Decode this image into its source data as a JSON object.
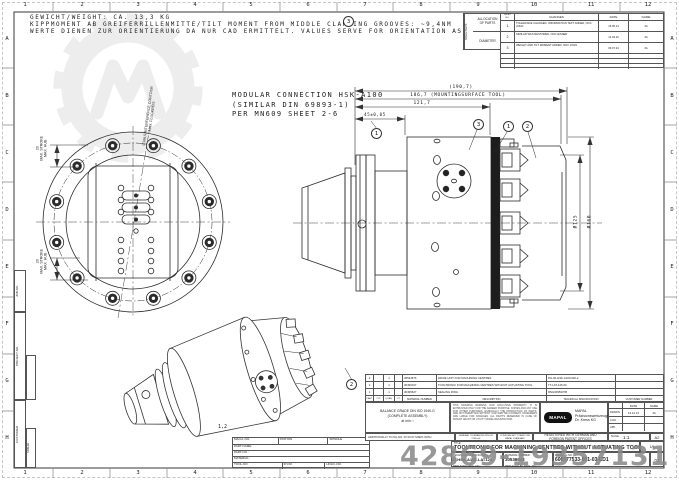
{
  "watermark": {
    "number": "42869-19357131"
  },
  "frame": {
    "columns": [
      "1",
      "2",
      "3",
      "4",
      "5",
      "6",
      "7",
      "8",
      "9",
      "10",
      "11",
      "12"
    ],
    "rows": [
      "A",
      "B",
      "C",
      "D",
      "E",
      "F",
      "G",
      "H"
    ],
    "left_fields": {
      "job_no": "JOB-NO.",
      "project_no": "PROJECT-NO.",
      "customer": "CUSTOMER",
      "similar": "SIMILAR"
    }
  },
  "notes": {
    "weight": "GEWICHT/WEIGHT: CA. 13,3 KG",
    "tilt": "KIPPMOMENT AB GREIFERRILLENMITTE/TILT MOMENT FROM MIDDLE CLAMPING GROOVES: ~9,4NM",
    "orientation": "WERTE DIENEN ZUR ORIENTIERUNG DA NUR CAD ERMITTELT. VALUES SERVE FOR ORIENTATION AS ONLY CAD DETERMINES."
  },
  "connection_note": "MODULAR CONNECTION HSK-A100\n(SIMILAR DIN 69893-1)\nPER  MN609 SHEET 2-6",
  "revision_table": {
    "allocation": {
      "title": "ALLOCATION\nOF PARTS",
      "spare": "SPARE PARTS",
      "diameter": "DIAMETER"
    },
    "headers": {
      "index": "INDEX\nNO.",
      "changes": "CHANGES",
      "date": "DATE",
      "name": "NAME"
    },
    "rows": [
      {
        "no": "1",
        "change": "TOLERANCE CHANGED, INFORMATION TEXT ADDED, NOC JOHN",
        "date": "15.05.14",
        "name": "JG"
      },
      {
        "no": "2",
        "change": "SIMILAR WAS RESTORED, NOC EISNER",
        "date": "14.03.20",
        "name": "JG"
      },
      {
        "no": "3",
        "change": "WEIGHT AND TILT MOMENT ADDED, NOC JOHN",
        "date": "09.07.24",
        "name": "JG"
      }
    ]
  },
  "dimensions": {
    "overall": "(190,7)",
    "mounting": "186,7 (MOUNTINGSURFACE TOOL)",
    "body": "121,7",
    "face": "45±0,05",
    "dia125": "Ø125",
    "dia160": "Ø160",
    "stroke_label": "20\nMAX. STROKE\nMAX. HUB",
    "interference": "Ø166,5 INTERFERENCE CONTOUR\nMAX. FLUGKREIS",
    "iso_ref": "1,2"
  },
  "balloons": {
    "b1": "1",
    "b2": "2",
    "b3": "3"
  },
  "parts_list": {
    "headers": {
      "part": "PART",
      "typ": "TYP",
      "quan": "QUAN.",
      "ut": "UT",
      "material_number": "MATERIAL NUMBER",
      "description": "DESCRIPTION",
      "technical_specification": "TECHNICAL SPECIFICATION",
      "customer_number": "CUSTOMER NUMBER"
    },
    "rows": [
      {
        "part": "3",
        "typ": "",
        "quan": "1",
        "ut": "",
        "material_number": "30534676",
        "description": "DRIVE UNIT FOR MACHINING CENTRES",
        "technical_specification": "DG-60-HSK-A100-920-2",
        "customer_number": ""
      },
      {
        "part": "2",
        "typ": "",
        "quan": "1",
        "ut": "",
        "material_number": "30496107",
        "description": "TOOLTRONIC FOR MACHINING CENTRES WITHOUT ACTUATING TOOL",
        "technical_specification": "TT-LAT-125-60",
        "customer_number": ""
      },
      {
        "part": "1",
        "typ": "",
        "quan": "1",
        "ut": "",
        "material_number": "30495627",
        "description": "SEALING RING",
        "technical_specification": "RNG6095307B",
        "customer_number": ""
      }
    ]
  },
  "title_block": {
    "balance": "BALANCE GRADE DIN ISO 1940-G\n(COMPLETE ASSEMBLY)\nat  min⁻¹",
    "disclaimer": "THIS DRAWING REMAINS OUR EXCLUSIVE PROPERTY. IT IS ENTRUSTED ONLY FOR THE AGREED PURPOSE. COPIES AND ANY USE FOR OTHER PURPOSES, ESPECIALLY THE PRODUCTION OF PARTS, ARE NOT PERMITTED WITHOUT OUR WRITTEN CONSENT. OFFENDERS ARE LIABLE FOR DAMAGES. ALL RIGHTS RESERVED IN CASE OF PATENT GRANT OR UTILITY MODEL REGISTRATION.",
    "logo_text": "MAPAL",
    "company": "MAPAL\nPräzisionswerkzeuge\nDr. Kress KG",
    "signatures": {
      "date_header": "DATE",
      "name_header": "NAME",
      "drawn_label": "DRAWN",
      "drawn_date": "16.12.13",
      "drawn_name": "JG",
      "chn_label": "CHN.",
      "app_label": "APP."
    },
    "additionally": "ADDITIONALLY TO KA-NO. 07.03.07 MARK WITH",
    "general_tol": "GENERAL TOLERANCES DIN ISO 2768-mK\nEDGES DIN ISO 13715",
    "conform": "CONFORM NOT STEADY WE MAPAL STANDARD",
    "patent": "REGISTERED WITH GERMAN AND\nFOREIGN PATENT OFFICES",
    "scale_label": "SCALE",
    "scale_value": "1:1",
    "format": "A2",
    "title_label": "TITLE:",
    "title": "TOOLTRONIC FOR MACHINING CENTRES WITHOUT ACTUATING TOOL",
    "sheet": "1/6",
    "tech_spec_label": "TECHNICAL SPECIFICATION:",
    "tech_spec": "D-HSK-A100-LAT125",
    "material_label": "MATERIAL NUMBER:",
    "material": "30536643",
    "drawing_label": "DRAWING NO.:",
    "drawing_no": "606077533-001-03-ED1",
    "index": "03",
    "replaces_label": "REPLACES DWG.-NO.:",
    "replaced_by_label": "REPLACED BY DWG.-NO.:"
  },
  "machine_block": {
    "mach": "MACH.-NO.",
    "station": "STATION",
    "spindle": "SPINDLE",
    "part_name": "PART-NAME:",
    "part_no": "PART-NO.:",
    "material": "MATERIAL:",
    "tool_no": "TOOL-NO.",
    "ip_no": "IP-NO.",
    "hold_no": "HOLD.-NO."
  }
}
